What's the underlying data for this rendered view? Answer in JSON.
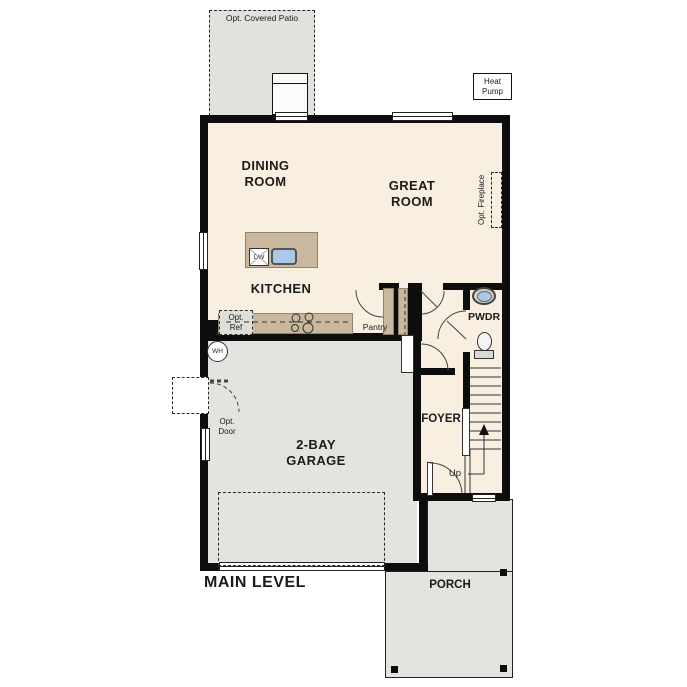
{
  "plan": {
    "title": "MAIN LEVEL",
    "rooms": {
      "dining": {
        "line1": "DINING",
        "line2": "ROOM"
      },
      "great": {
        "line1": "GREAT",
        "line2": "ROOM"
      },
      "kitchen": "KITCHEN",
      "garage": {
        "line1": "2-BAY",
        "line2": "GARAGE"
      },
      "foyer": "FOYER",
      "pwdr": "PWDR",
      "pantry": "Pantry",
      "porch": "PORCH"
    },
    "annotations": {
      "patio": "Opt. Covered Patio",
      "heat_pump": {
        "line1": "Heat",
        "line2": "Pump"
      },
      "opt_fireplace": "Opt. Fireplace",
      "opt_ref": {
        "line1": "Opt.",
        "line2": "Ref"
      },
      "opt_door": {
        "line1": "Opt.",
        "line2": "Door"
      },
      "water_heater": "WH",
      "dishwasher": "DW",
      "stairs_up": "Up"
    },
    "colors": {
      "floor": "#f8efe1",
      "concrete": "#e4e3df",
      "patio": "#e2e1dd",
      "counter_tan": "#c9b89e",
      "sink_blue": "#abc9e6",
      "wall": "#0d0d0d",
      "text": "#1b1b1b"
    }
  }
}
